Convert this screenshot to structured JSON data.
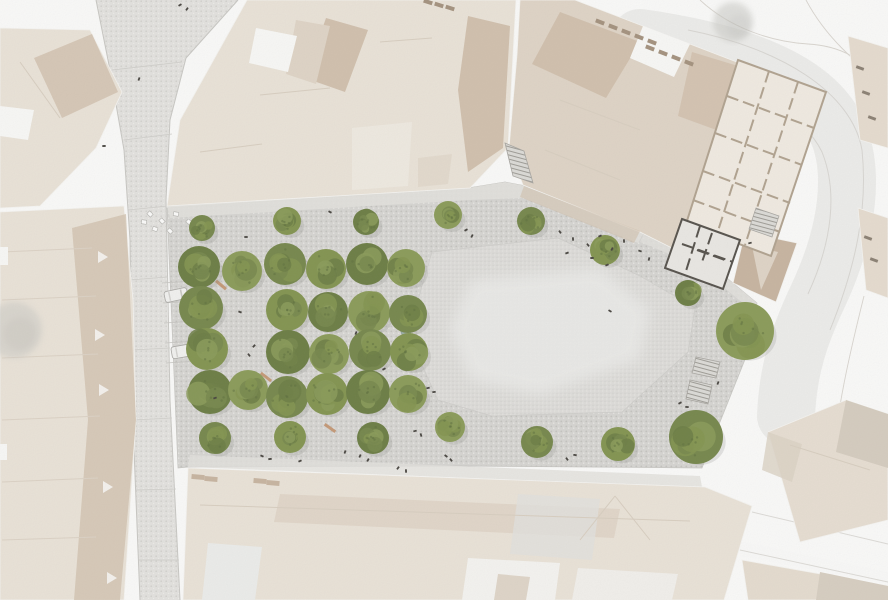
{
  "meta": {
    "description": "Architectural site plan render – aerial view of a town square with a grid of trees, cobbled plaza, light fountain surface, stairs and surrounding historic buildings"
  },
  "canvas": {
    "width": 888,
    "height": 600
  },
  "palette": {
    "bg": "#fcfcfb",
    "street": "#e4e3e0",
    "streetDot1": "#d2d1cd",
    "streetDot2": "#efeeea",
    "cobble": "#d7d6d3",
    "cobbleDot1": "#c5c4c0",
    "cobbleDot2": "#e8e7e4",
    "fountain": "#deddda",
    "fountainDot": "#d1d0cd",
    "fountainCore": "#ececea",
    "band": "#e3e2de",
    "roofLight": "#ebe4d9",
    "roofMid": "#e0d5c7",
    "roofDark": "#d2c1ae",
    "roofTaupe": "#c8b5a1",
    "roofPale": "#f0ebe2",
    "white": "#fafaf8",
    "lineRoof": "#d9cfc1",
    "treeCols": [
      "#75874b",
      "#82944f",
      "#6b7d43",
      "#8a9b58"
    ],
    "treeSpeckle": "#5c6e3c",
    "shadow": "#8e8e88",
    "planFill": "#f2ece3",
    "planWall": "#b1a390",
    "planOutline": "#a99b89",
    "planDarkWall": "#55514b",
    "planDarkFill": "#ebe9e5",
    "road": "#ededeb",
    "roadEdge": "#d9d7d3",
    "contour": "#dad6d0",
    "curb": "#c9c8c4",
    "joint": "#d0cfcb",
    "parking": "#c6c5c1",
    "people": "#45423d",
    "carBody": "#f3f3f1",
    "carLine": "#a9a8a4",
    "bench": "#c08a5f",
    "teal": "#9fb2ab",
    "chimney": "#a4927e",
    "dashMark": "#8b8073",
    "stairEdge": "#a7a5a0",
    "hatchLine": "#97958f"
  },
  "streets": {
    "left_polygon": "238,0 186,58 170,120 166,200 167,300 170,400 175,500 180,600 140,600 135,480 131,360 130,240 124,150 110,70 96,0",
    "curb_east": "238,0 186,58 170,120 166,200 170,400 180,600",
    "curb_west": "96,0 110,70 124,150 130,240 132,400 140,600",
    "joints": [
      [
        112,
        70,
        182,
        62
      ],
      [
        124,
        140,
        172,
        134
      ],
      [
        128,
        210,
        168,
        206
      ],
      [
        129,
        280,
        168,
        277
      ],
      [
        131,
        350,
        170,
        348
      ],
      [
        133,
        420,
        172,
        418
      ],
      [
        136,
        490,
        176,
        489
      ],
      [
        139,
        560,
        179,
        560
      ]
    ],
    "parking_lines": [
      [
        162,
        283,
        196,
        281
      ],
      [
        163,
        303,
        197,
        301
      ],
      [
        164,
        323,
        198,
        321
      ],
      [
        165,
        343,
        199,
        341
      ],
      [
        166,
        363,
        200,
        361
      ]
    ],
    "road_swath": "M640,38 C740,52 812,80 836,128 C856,170 848,232 818,296 C800,334 788,368 786,416",
    "road_edges": [
      "M600,54 C716,72 798,102 822,152 C838,192 832,242 808,294",
      "M688,30 C780,48 852,92 862,150 C868,208 856,266 830,330"
    ],
    "contours": [
      "M700,0 C730,28 772,42 808,44 C842,46 864,60 876,80",
      "M806,0 C824,34 856,66 888,84",
      "M864,296 C850,352 836,412 832,470"
    ],
    "sw_band": "735,540 888,572 888,584 742,556",
    "sw_lines": [
      [
        752,
        512,
        888,
        544
      ],
      [
        740,
        550,
        888,
        582
      ]
    ],
    "corner_white": "0,540 48,545 38,600 0,600"
  },
  "plaza": {
    "polygon": "167,208 468,188 505,182 526,186 645,231 704,259 757,303 748,352 716,432 702,468 460,466 188,467 178,468",
    "bands": [
      {
        "pts": "167,206 468,188 505,182 526,186 645,231 638,243 524,198 470,200 170,218",
        "op": 0.9
      },
      {
        "pts": "190,455 700,476 702,487 188,467",
        "op": 0.8
      },
      {
        "pts": "645,231 704,259 757,303 748,352 737,349 745,305 698,266 640,242",
        "op": 0.8
      }
    ],
    "fountain_outer": "432,252 558,238 640,276 695,308 688,352 622,412 492,416 438,400 416,352 418,300",
    "fountain_core": "470,280 600,268 650,310 640,360 540,395 470,380 450,330",
    "teal_circle": {
      "x": 406,
      "y": 331,
      "r": 5
    }
  },
  "buildings": [
    {
      "name": "building-north-block",
      "base": "247,0 516,0 508,148 470,188 167,206 180,120",
      "fill": "roofLight",
      "facets": [
        {
          "pts": "326,18 368,30 345,92 305,78",
          "fill": "roofDark"
        },
        {
          "pts": "468,16 510,26 503,148 468,172 458,90",
          "fill": "roofDark"
        },
        {
          "pts": "296,20 330,26 316,84 286,74",
          "fill": "roofMid"
        },
        {
          "pts": "352,128 412,122 408,186 352,190",
          "fill": "roofPale"
        },
        {
          "pts": "256,28 297,36 288,72 249,63",
          "fill": "white"
        },
        {
          "pts": "418,158 452,154 448,184 418,187",
          "fill": "roofMid",
          "op": 0.6
        }
      ],
      "lines": [
        [
          260,
          95,
          330,
          88
        ],
        [
          380,
          42,
          432,
          38
        ],
        [
          200,
          152,
          262,
          144
        ]
      ],
      "rects": [
        [
          428,
          2,
          9,
          4,
          18,
          "chimney"
        ],
        [
          439,
          5,
          9,
          4,
          18,
          "chimney"
        ],
        [
          450,
          8,
          9,
          4,
          18,
          "chimney"
        ]
      ]
    },
    {
      "name": "building-northeast-block",
      "base": "520,0 575,0 742,64 700,262 640,232 523,185 509,148 517,55",
      "fill": "roofMid",
      "facets": [
        {
          "pts": "560,12 640,42 606,98 532,64",
          "fill": "roofDark"
        },
        {
          "pts": "643,26 690,44 674,77 630,58",
          "fill": "white"
        },
        {
          "pts": "692,52 738,66 722,132 678,116",
          "fill": "roofDark",
          "op": 0.85
        },
        {
          "pts": "524,186 640,231 634,243 520,197",
          "fill": "roofDark",
          "op": 0.6
        }
      ],
      "lines": [
        [
          560,
          100,
          640,
          130
        ],
        [
          545,
          150,
          620,
          180
        ]
      ],
      "rects": [
        [
          600,
          22,
          9,
          4,
          21,
          "chimney"
        ],
        [
          613,
          27,
          9,
          4,
          21,
          "chimney"
        ],
        [
          626,
          32,
          9,
          4,
          21,
          "chimney"
        ],
        [
          639,
          37,
          9,
          4,
          21,
          "chimney"
        ],
        [
          652,
          42,
          9,
          4,
          21,
          "chimney"
        ],
        [
          650,
          48,
          9,
          4,
          21,
          "chimney"
        ],
        [
          663,
          53,
          9,
          4,
          21,
          "chimney"
        ],
        [
          676,
          58,
          9,
          4,
          21,
          "chimney"
        ],
        [
          689,
          63,
          9,
          4,
          21,
          "chimney"
        ]
      ]
    },
    {
      "name": "building-east-wedge",
      "base": "745,232 797,243 776,302 733,283",
      "fill": "roofTaupe",
      "facets": [
        {
          "pts": "752,246 778,252 761,290",
          "fill": "roofMid"
        }
      ],
      "lines": [],
      "rects": []
    },
    {
      "name": "building-west-corner",
      "base": "0,28 90,30 122,92 96,148 40,206 0,208",
      "fill": "roofLight",
      "facets": [
        {
          "pts": "34,58 92,34 118,92 62,118",
          "fill": "roofDark",
          "op": 0.8
        },
        {
          "pts": "0,106 34,110 28,140 0,136",
          "fill": "white"
        }
      ],
      "lines": [
        [
          20,
          62,
          60,
          118
        ]
      ],
      "rects": []
    },
    {
      "name": "building-west-row",
      "base": "0,212 124,206 133,300 136,420 124,600 0,600",
      "fill": "roofLight",
      "facets": [
        {
          "pts": "72,228 126,214 136,420 120,600 74,600 88,420",
          "fill": "roofDark",
          "op": 0.75
        }
      ],
      "lines": [
        [
          2,
          252,
          92,
          248
        ],
        [
          2,
          300,
          96,
          296
        ],
        [
          2,
          358,
          98,
          354
        ],
        [
          2,
          420,
          100,
          416
        ],
        [
          2,
          482,
          98,
          478
        ],
        [
          2,
          540,
          96,
          537
        ]
      ],
      "lineColor": "#ddd3c6",
      "rects": [
        [
          0,
          256,
          16,
          18,
          0,
          "white"
        ],
        [
          0,
          452,
          14,
          16,
          0,
          "white"
        ]
      ],
      "dormers": [
        [
          103,
          257
        ],
        [
          100,
          335
        ],
        [
          104,
          390
        ],
        [
          108,
          487
        ],
        [
          112,
          578
        ]
      ]
    },
    {
      "name": "building-south-block",
      "base": "188,468 705,487 752,506 724,600 183,600",
      "fill": "roofLight",
      "facets": [
        {
          "pts": "280,494 620,509 614,538 274,522",
          "fill": "roofMid",
          "op": 0.85
        },
        {
          "pts": "518,494 600,499 592,560 510,554",
          "fill": "#e4e2de",
          "op": 0.8
        },
        {
          "pts": "208,543 262,547 255,600 202,600",
          "fill": "#edeeec"
        },
        {
          "pts": "468,558 560,563 555,600 462,600",
          "fill": "#f6f5f2"
        },
        {
          "pts": "578,568 678,574 672,600 572,600",
          "fill": "#f3f1ed"
        },
        {
          "pts": "498,574 530,577 526,600 494,600",
          "fill": "roofDark",
          "op": 0.6
        }
      ],
      "lines": [
        [
          615,
          496,
          650,
          540
        ],
        [
          615,
          496,
          580,
          540
        ],
        [
          200,
          505,
          690,
          521
        ]
      ],
      "rects": [
        [
          198,
          477,
          5,
          13,
          95,
          "roofTaupe"
        ],
        [
          211,
          479,
          5,
          13,
          95,
          "roofTaupe"
        ],
        [
          260,
          481,
          5,
          13,
          95,
          "roofTaupe"
        ],
        [
          273,
          483,
          5,
          13,
          95,
          "roofTaupe"
        ]
      ]
    },
    {
      "name": "building-southeast-block",
      "base": "768,432 846,400 888,414 888,520 800,542",
      "fill": "#e8dfd3",
      "facets": [
        {
          "pts": "846,400 888,414 888,468 836,452",
          "fill": "#d6cdc0"
        },
        {
          "pts": "768,432 802,444 792,482 762,470",
          "fill": "#dcd3c6",
          "op": 0.8
        }
      ],
      "lines": [
        [
          790,
          445,
          870,
          470
        ]
      ],
      "rects": []
    },
    {
      "name": "building-southeast-strip",
      "base": "742,560 888,586 888,600 748,600",
      "fill": "#e6ddd0",
      "facets": [
        {
          "pts": "820,572 888,586 888,600 816,600",
          "fill": "#d8cfc2"
        }
      ],
      "lines": [],
      "rects": []
    },
    {
      "name": "building-east-sliver-north",
      "base": "848,36 888,48 888,148 860,140",
      "fill": "#e7ddd0",
      "facets": [],
      "lines": [],
      "rects": [
        [
          860,
          68,
          8,
          3,
          20,
          "dashMark"
        ],
        [
          866,
          93,
          8,
          3,
          20,
          "dashMark"
        ],
        [
          872,
          118,
          8,
          3,
          20,
          "dashMark"
        ]
      ]
    },
    {
      "name": "building-east-sliver-south",
      "base": "858,208 888,218 888,298 866,290",
      "fill": "#e7ddd0",
      "facets": [],
      "lines": [],
      "rects": [
        [
          868,
          238,
          8,
          3,
          20,
          "dashMark"
        ],
        [
          874,
          260,
          8,
          3,
          20,
          "dashMark"
        ]
      ]
    }
  ],
  "floorplans": [
    {
      "name": "floor-plan-building-large",
      "outline": "738,60 826,92 771,256 686,224",
      "fill": "planFill",
      "wallColor": "planWall",
      "walls": [
        [
          727,
          96,
          814,
          128
        ],
        [
          715,
          133,
          802,
          165
        ],
        [
          703,
          171,
          790,
          203
        ],
        [
          693,
          200,
          780,
          232
        ],
        [
          769,
          71,
          717,
          234
        ],
        [
          798,
          82,
          745,
          245
        ]
      ],
      "hatch": "756,208 779,216 772,237 749,229"
    },
    {
      "name": "floor-plan-building-small",
      "outline": "682,219 740,240 723,289 665,268",
      "fill": "planDarkFill",
      "wallColor": "planDarkWall",
      "walls": [
        [
          700,
          226,
          686,
          271
        ],
        [
          682,
          244,
          733,
          262
        ],
        [
          712,
          233,
          702,
          262
        ],
        [
          697,
          250,
          725,
          260
        ]
      ],
      "hatch": null
    }
  ],
  "stairs": [
    {
      "name": "stairs-passage-north",
      "pts": "505,143 524,151 533,183 513,176"
    },
    {
      "name": "stairs-east-upper",
      "pts": "696,357 720,362 716,378 692,373"
    },
    {
      "name": "stairs-east-lower",
      "pts": "690,380 712,385 708,404 686,399"
    }
  ],
  "trees": [
    [
      202,
      228,
      13
    ],
    [
      287,
      221,
      14
    ],
    [
      366,
      222,
      13
    ],
    [
      448,
      215,
      14
    ],
    [
      531,
      221,
      14
    ],
    [
      605,
      250,
      15
    ],
    [
      199,
      267,
      21
    ],
    [
      242,
      271,
      20
    ],
    [
      285,
      264,
      21
    ],
    [
      326,
      269,
      20
    ],
    [
      367,
      264,
      21
    ],
    [
      406,
      268,
      19
    ],
    [
      201,
      308,
      22
    ],
    [
      287,
      310,
      21
    ],
    [
      328,
      312,
      20
    ],
    [
      369,
      312,
      21
    ],
    [
      408,
      314,
      19
    ],
    [
      207,
      349,
      21
    ],
    [
      288,
      352,
      22
    ],
    [
      329,
      354,
      20
    ],
    [
      370,
      350,
      21
    ],
    [
      409,
      352,
      19
    ],
    [
      210,
      392,
      22
    ],
    [
      248,
      390,
      20
    ],
    [
      287,
      397,
      21
    ],
    [
      327,
      394,
      21
    ],
    [
      368,
      392,
      22
    ],
    [
      408,
      394,
      19
    ],
    [
      215,
      438,
      16
    ],
    [
      290,
      437,
      16
    ],
    [
      373,
      438,
      16
    ],
    [
      450,
      427,
      15
    ],
    [
      537,
      442,
      16
    ],
    [
      618,
      444,
      17
    ],
    [
      688,
      293,
      13
    ],
    [
      745,
      331,
      29
    ],
    [
      696,
      437,
      27
    ]
  ],
  "gray_trees": [
    [
      733,
      22,
      20,
      0.55
    ],
    [
      14,
      330,
      28,
      0.5
    ]
  ],
  "furniture": {
    "white_chairs": [
      [
        150,
        214
      ],
      [
        162,
        221
      ],
      [
        176,
        214
      ],
      [
        155,
        229
      ],
      [
        189,
        222
      ],
      [
        170,
        231
      ],
      [
        144,
        222
      ]
    ],
    "benches": [
      [
        221,
        285,
        40
      ],
      [
        266,
        377,
        38
      ],
      [
        330,
        428,
        35
      ]
    ]
  },
  "cars": [
    {
      "x": 176,
      "y": 295,
      "rot": 78,
      "w": 11,
      "l": 23
    },
    {
      "x": 184,
      "y": 351,
      "rot": 80,
      "w": 12,
      "l": 25
    }
  ],
  "people": [
    [
      180,
      5
    ],
    [
      187,
      9
    ],
    [
      139,
      79
    ],
    [
      104,
      146
    ],
    [
      330,
      212
    ],
    [
      246,
      237
    ],
    [
      240,
      312
    ],
    [
      254,
      346
    ],
    [
      249,
      355
    ],
    [
      356,
      333
    ],
    [
      384,
      369
    ],
    [
      428,
      388
    ],
    [
      434,
      392
    ],
    [
      215,
      398
    ],
    [
      560,
      232
    ],
    [
      573,
      239
    ],
    [
      588,
      245
    ],
    [
      600,
      236
    ],
    [
      612,
      249
    ],
    [
      624,
      241
    ],
    [
      592,
      258
    ],
    [
      567,
      253
    ],
    [
      607,
      265
    ],
    [
      640,
      251
    ],
    [
      649,
      259
    ],
    [
      466,
      230
    ],
    [
      472,
      236
    ],
    [
      610,
      311
    ],
    [
      680,
      403
    ],
    [
      687,
      407
    ],
    [
      575,
      455
    ],
    [
      567,
      459
    ],
    [
      360,
      456
    ],
    [
      368,
      460
    ],
    [
      345,
      452
    ],
    [
      415,
      431
    ],
    [
      421,
      435
    ],
    [
      446,
      456
    ],
    [
      451,
      460
    ],
    [
      398,
      468
    ],
    [
      406,
      471
    ],
    [
      262,
      456
    ],
    [
      270,
      459
    ],
    [
      300,
      461
    ],
    [
      750,
      243
    ],
    [
      718,
      383
    ]
  ]
}
